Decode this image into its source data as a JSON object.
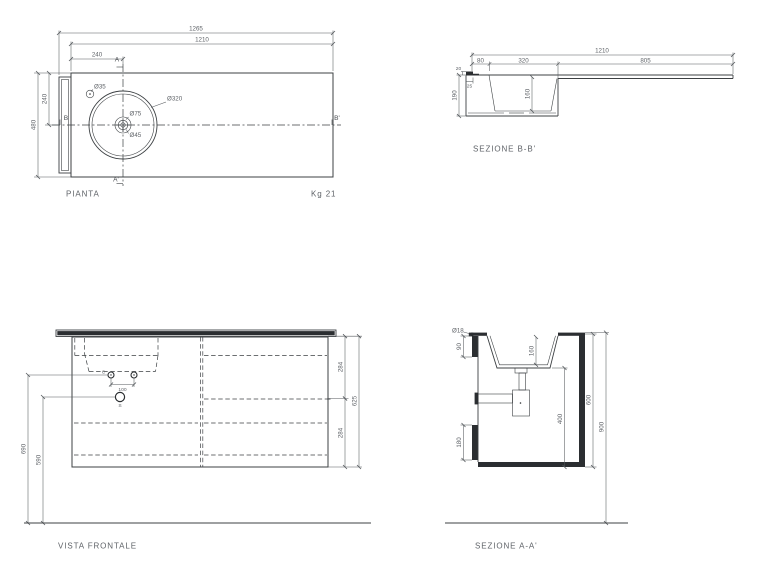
{
  "pianta": {
    "title": "PIANTA",
    "weight": "Kg 21",
    "dims": {
      "total_width": "1265",
      "top_width": "1210",
      "basin_offset": "240",
      "axis_depth": "240",
      "total_depth": "480",
      "hole": "Ø35",
      "basin": "Ø320",
      "faucet_outer": "Ø75",
      "faucet_inner": "Ø45"
    },
    "marks": {
      "a_top": "A",
      "a_bottom": "A'",
      "b_left": "B",
      "b_right": "B'"
    }
  },
  "sezione_bb": {
    "title": "SEZIONE B-B'",
    "dims": {
      "width": "1210",
      "left_seg": "80",
      "basin_seg": "320",
      "right_seg": "805",
      "height": "190",
      "basin_depth": "160",
      "lip_width": "25",
      "lip_height": "20"
    }
  },
  "vista_frontale": {
    "title": "VISTA FRONTALE",
    "dims": {
      "supply_height": "690",
      "drain_height": "590",
      "supply_spacing": "100",
      "upper_drawer": "284",
      "lower_drawer": "284",
      "cabinet_height": "625"
    },
    "marks": {
      "supply": "C",
      "drain": "S"
    }
  },
  "sezione_aa": {
    "title": "SEZIONE A-A'",
    "dims": {
      "hole": "Ø18",
      "bracket_upper": "90",
      "basin_depth": "160",
      "trap_height": "400",
      "inner_height": "600",
      "total_height": "900",
      "bracket_lower": "180"
    }
  }
}
